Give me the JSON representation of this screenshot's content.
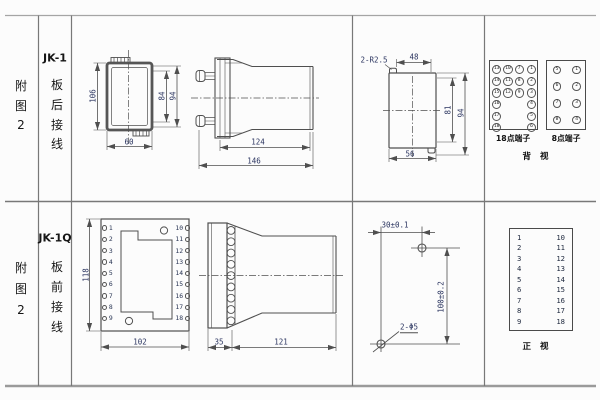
{
  "colors": {
    "line": "#4f4f4f",
    "dim_text": "#2b3560",
    "text": "#161616",
    "grid": "#8a8a8a",
    "bg": "#fcfcfc"
  },
  "row1": {
    "index": [
      "附",
      "图",
      "2"
    ],
    "model": "JK-1",
    "wiring": [
      "板",
      "后",
      "接",
      "线"
    ],
    "back_view": {
      "dim_height": "106",
      "dim_inner_height": "84",
      "dim_outer_height": "94",
      "dim_width": "60"
    },
    "side_view": {
      "dim_body": "124",
      "dim_total": "146"
    },
    "cutout": {
      "label_radius": "2-R2.5",
      "dim_top": "48",
      "dim_inner": "81",
      "dim_outer": "94",
      "dim_bottom": "56"
    },
    "terminals18": {
      "label": "18点端子",
      "grid": [
        [
          13,
          10,
          7,
          1
        ],
        [
          14,
          11,
          8,
          2
        ],
        [
          15,
          12,
          9,
          3
        ],
        [
          16,
          null,
          null,
          4
        ],
        [
          17,
          null,
          null,
          5
        ],
        [
          18,
          null,
          null,
          6
        ]
      ]
    },
    "terminals8": {
      "label": "8点端子",
      "grid": [
        [
          5,
          1
        ],
        [
          6,
          2
        ],
        [
          7,
          3
        ],
        [
          8,
          4
        ]
      ]
    },
    "view_label": "背 视"
  },
  "row2": {
    "index": [
      "附",
      "图",
      "2"
    ],
    "model": "JK-1Q",
    "wiring": [
      "板",
      "前",
      "接",
      "线"
    ],
    "front_view": {
      "dim_height": "118",
      "dim_width": "102",
      "left_terminals": [
        1,
        2,
        3,
        4,
        5,
        6,
        7,
        8,
        9
      ],
      "right_terminals": [
        10,
        11,
        12,
        13,
        14,
        15,
        16,
        17,
        18
      ]
    },
    "side_view": {
      "dim_flange": "35",
      "dim_body": "121"
    },
    "drill": {
      "dim_horizontal": "30±0.1",
      "dim_vertical": "100±0.2",
      "hole_label": "2-Φ5"
    },
    "num_table": {
      "left": [
        1,
        2,
        3,
        4,
        5,
        6,
        7,
        8,
        9
      ],
      "right": [
        10,
        11,
        12,
        13,
        14,
        15,
        16,
        17,
        18
      ]
    },
    "view_label": "正 视"
  }
}
